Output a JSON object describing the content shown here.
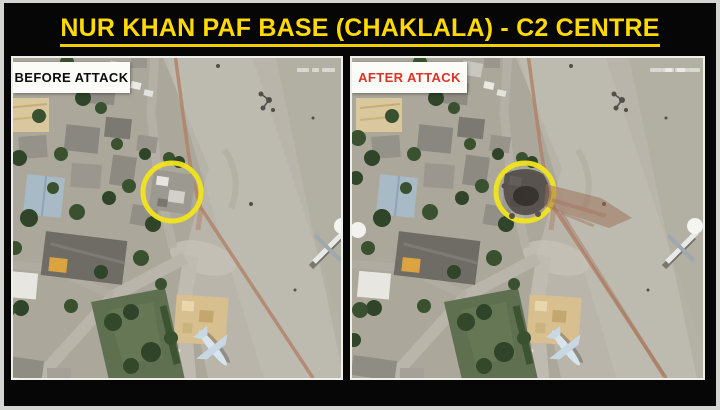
{
  "header": {
    "title": "NUR KHAN PAF BASE (CHAKLALA) - C2 CENTRE",
    "title_color": "#FFD900",
    "title_underline": true,
    "background_color": "#060606"
  },
  "panels": {
    "before": {
      "label": "BEFORE ATTACK",
      "label_color": "#0D0D0D",
      "label_background": "#FBFBF8"
    },
    "after": {
      "label": "AFTER ATTACK",
      "label_color": "#D93425",
      "label_background": "#FBFBF8"
    }
  },
  "annotation": {
    "target_circle_color": "#F1E41C",
    "damage_plume_color": "#9C6D55"
  },
  "frame": {
    "outer_border_color": "#D8D8D4"
  }
}
